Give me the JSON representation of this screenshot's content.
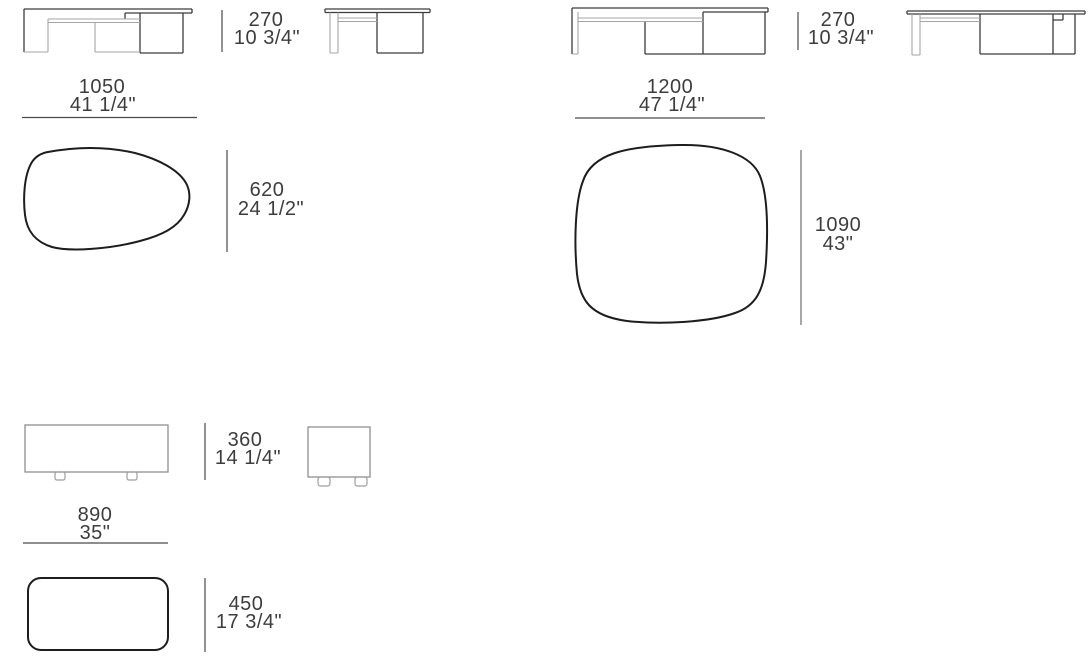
{
  "document": {
    "kind": "furniture-dimension-sheet",
    "background": "#ffffff",
    "colors": {
      "cad_line": "#3c3c3c",
      "cad_light_line": "#a6a6a6",
      "dimension_line": "#4a4a4a",
      "top_view_outline": "#1d1d1d",
      "text": "#3d3d3d"
    }
  },
  "dims": {
    "tableA": {
      "h_mm": "270",
      "h_in": "10 3/4\"",
      "w_mm": "1050",
      "w_in": "41 1/4\"",
      "top_mm": "620",
      "top_in": "24 1/2\""
    },
    "tableB": {
      "h_mm": "270",
      "h_in": "10 3/4\"",
      "w_mm": "1200",
      "w_in": "47 1/4\"",
      "top_mm": "1090",
      "top_in": "43\""
    },
    "ottoman": {
      "h_mm": "360",
      "h_in": "14 1/4\"",
      "w_mm": "890",
      "w_in": "35\"",
      "top_mm": "450",
      "top_in": "17 3/4\""
    }
  }
}
